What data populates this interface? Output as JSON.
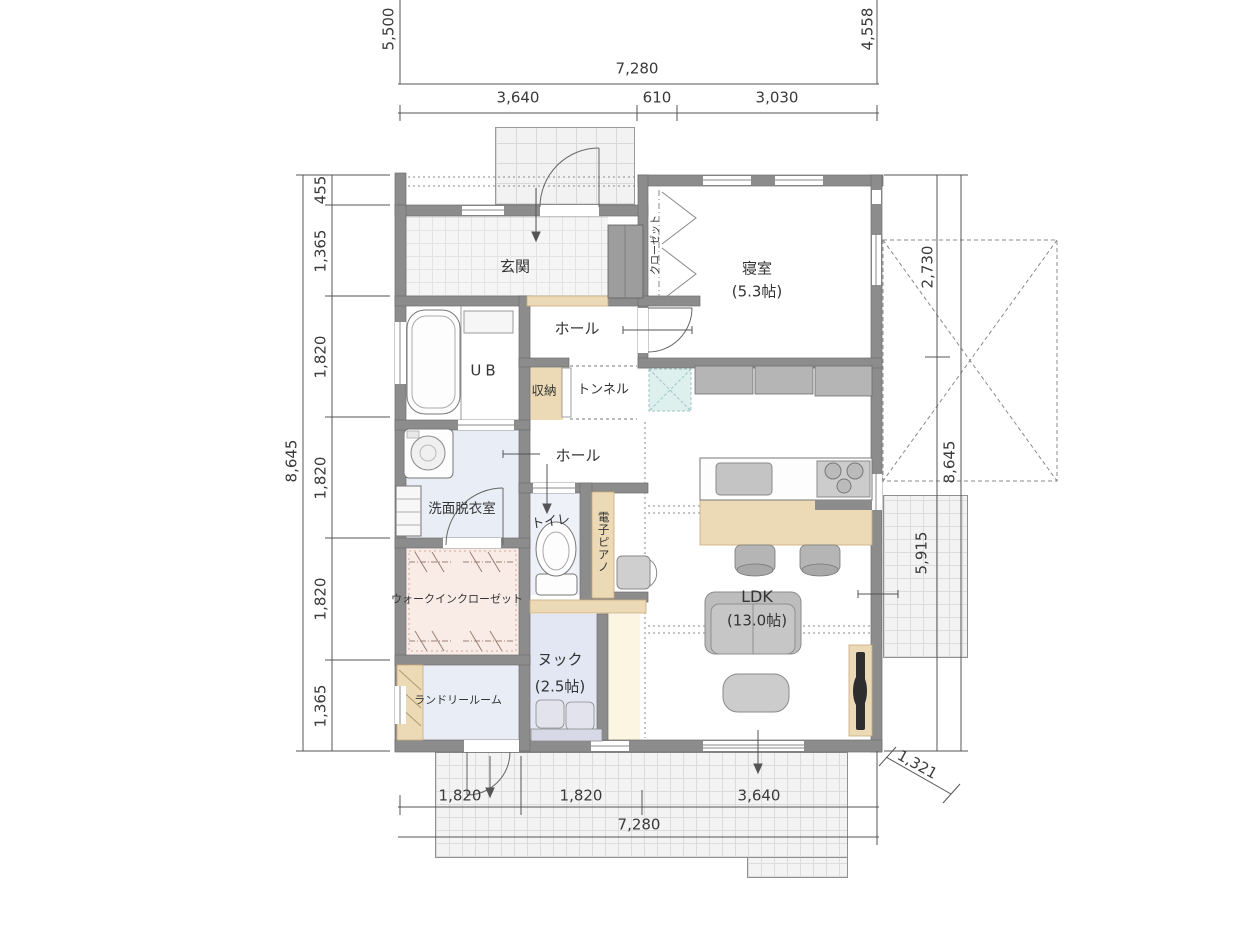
{
  "rooms": {
    "genkan": "玄関",
    "bedroom": "寝室",
    "bedroom_size": "(5.3帖)",
    "closet": "クローゼット",
    "hall_upper": "ホール",
    "hall_lower": "ホール",
    "ub": "UB",
    "storage": "収納",
    "tunnel": "トンネル",
    "washroom": "洗面脱衣室",
    "toilet": "トイレ",
    "piano": "電子ピアノ",
    "wic": "ウォークインクローゼット",
    "ldk": "LDK",
    "ldk_size": "(13.0帖)",
    "nook": "ヌック",
    "nook_size": "(2.5帖)",
    "laundry": "ランドリールーム"
  },
  "dims": {
    "left_upper_vertical": "5,500",
    "right_upper_vertical": "4,558",
    "top_total": "7,280",
    "top_seg_1": "3,640",
    "top_seg_2": "610",
    "top_seg_3": "3,030",
    "left_total": "8,645",
    "left_seg_1": "455",
    "left_seg_2": "1,365",
    "left_seg_3": "1,820",
    "left_seg_4": "1,820",
    "left_seg_5": "1,820",
    "left_seg_6": "1,365",
    "right_seg_upper": "2,730",
    "right_total": "8,645",
    "right_seg_lower": "5,915",
    "right_diagonal": "1,321",
    "bottom_seg_1": "1,820",
    "bottom_seg_2": "1,820",
    "bottom_seg_3": "3,640",
    "bottom_total": "7,280"
  },
  "colors": {
    "wall": "#8c8c8c",
    "tatami_accent": "#def0ee",
    "wood_counter": "#ecd9b5",
    "wet_floor_blue": "#e9eef6",
    "wic_floor_pink": "#f9ece7",
    "nook_floor_lavender": "#e2e7f3",
    "fixture_gray": "#b5b5b5"
  }
}
